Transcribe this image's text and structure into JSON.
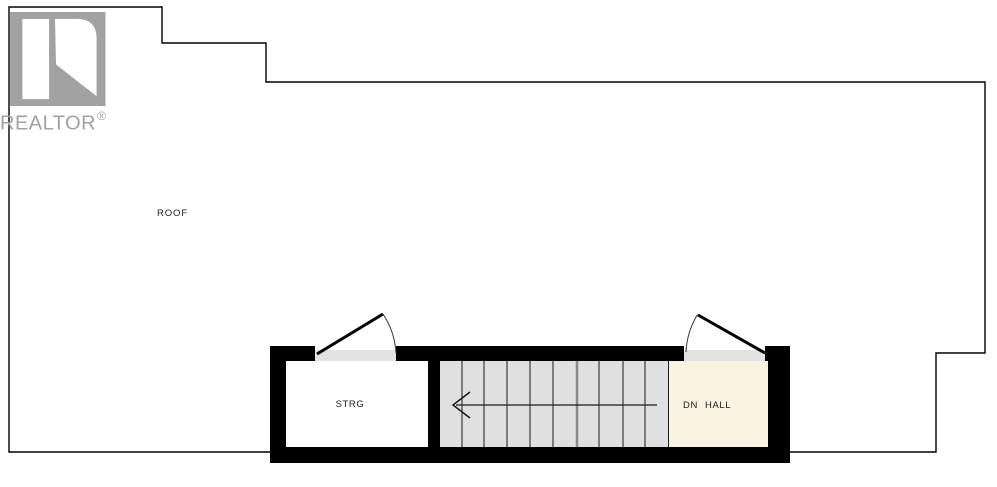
{
  "branding": {
    "logo_text": "REALTOR",
    "registered_mark": "®",
    "logo_color": "#a2a2a2"
  },
  "plan": {
    "areas": {
      "roof": {
        "label": "ROOF"
      },
      "storage": {
        "label": "STRG"
      },
      "hall": {
        "direction_label": "DN",
        "label": "HALL"
      }
    },
    "stairs": {
      "tread_count": 10,
      "arrow_direction": "left"
    },
    "colors": {
      "background": "#ffffff",
      "outline": "#000000",
      "wall": "#000000",
      "room_fill": "#ffffff",
      "stairs_fill": "#e0e0e0",
      "hall_fill": "#faf3e1",
      "threshold_fill": "#e3e3e3",
      "tread_line": "#1a1a1a",
      "divider_line": "#8a8a8a",
      "label_text": "#1c1c1c"
    }
  }
}
